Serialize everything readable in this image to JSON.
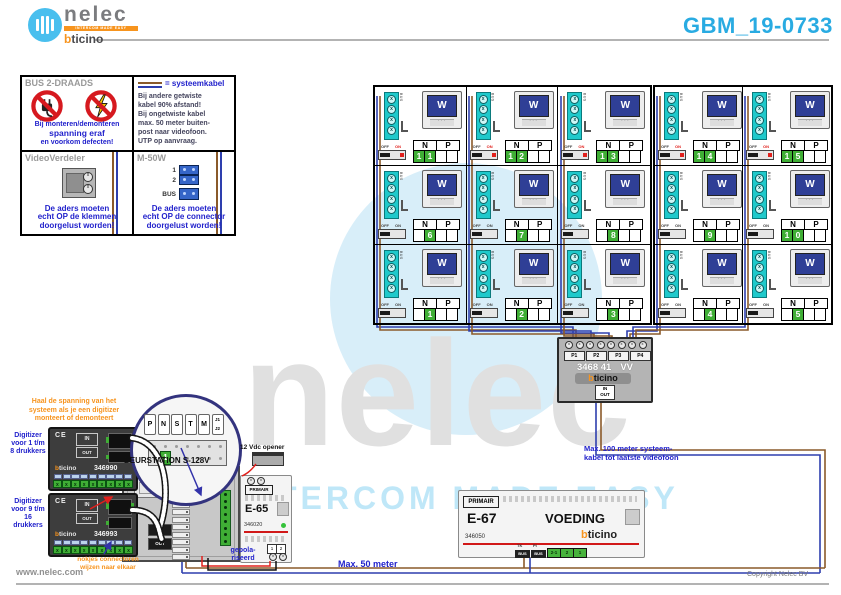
{
  "header": {
    "logo": {
      "name": "nelec",
      "tagline": "INTERCOM MADE EASY",
      "brand_b": "b",
      "brand_rest": "ticino"
    },
    "title": "GBM_19-0733"
  },
  "info": {
    "bus2": {
      "title": "BUS 2-DRAADS",
      "line1": "Bij monteren/demonteren",
      "line2": "spanning eraf",
      "line3": "en voorkom defecten!"
    },
    "kabel": {
      "legend": "= systeemkabel",
      "text": "Bij andere getwiste\nkabel 90% afstand!\nBij ongetwiste kabel\nmax. 50 meter buiten-\npost naar videofoon.\nUTP op aanvraag."
    },
    "verdeler": {
      "title": "VideoVerdeler",
      "text": "De aders moeten\necht OP de klemmen\ndoorgelust worden!"
    },
    "m50w": {
      "title": "M-50W",
      "labels": [
        "1",
        "2",
        "BUS"
      ],
      "text": "De aders moeten\necht OP de connector\ndoorgelust worden!"
    }
  },
  "monitor": {
    "screen": "W",
    "bus": "BUS",
    "off": "OFF",
    "on": "ON",
    "n": "N",
    "p": "P"
  },
  "grids": {
    "left": [
      [
        {
          "d": [
            "1",
            "1"
          ],
          "t": true
        },
        {
          "d": [
            "1",
            "2"
          ],
          "t": true
        },
        {
          "d": [
            "1",
            "3"
          ],
          "t": true
        }
      ],
      [
        {
          "d": [
            "",
            "6"
          ]
        },
        {
          "d": [
            "",
            "7"
          ]
        },
        {
          "d": [
            "",
            "8"
          ]
        }
      ],
      [
        {
          "d": [
            "",
            "1"
          ]
        },
        {
          "d": [
            "",
            "2"
          ]
        },
        {
          "d": [
            "",
            "3"
          ]
        }
      ]
    ],
    "right": [
      [
        {
          "d": [
            "1",
            "4"
          ],
          "t": true
        },
        {
          "d": [
            "1",
            "5"
          ],
          "t": true
        }
      ],
      [
        {
          "d": [
            "",
            "9"
          ]
        },
        {
          "d": [
            "1",
            "0"
          ]
        }
      ],
      [
        {
          "d": [
            "",
            "4"
          ]
        },
        {
          "d": [
            "",
            "5"
          ]
        }
      ]
    ]
  },
  "distributor": {
    "ports": [
      "P1",
      "P2",
      "P3",
      "P4"
    ],
    "model": "3468 41",
    "suffix": "VV",
    "in": "IN",
    "out": "OUT"
  },
  "deurstation": {
    "label": "DEURSTATION S-128V",
    "slots": [
      "P",
      "N",
      "S",
      "T",
      "M"
    ],
    "jumper": "J1\nJ2",
    "config_value": "1",
    "in": "IN",
    "out": "OUT"
  },
  "digitizers": [
    {
      "label": "Digitizer\nvoor\n1 t/m 8\ndrukkers",
      "ce": "CE",
      "in": "IN",
      "out": "OUT",
      "model": "346990"
    },
    {
      "label": "Digitizer\nvoor\n9 t/m 16\ndrukkers",
      "ce": "CE",
      "in": "IN",
      "out": "OUT",
      "model": "346993"
    }
  ],
  "e65": {
    "primair": "PRIMAIR",
    "model": "E-65",
    "code": "346020",
    "terminals": [
      "1",
      "2"
    ],
    "note": "gepola-\nriseerd"
  },
  "e67": {
    "primair": "PRIMAIR",
    "model": "E-67",
    "type": "VOEDING",
    "code": "346050",
    "top_labels": [
      "TK",
      "PI"
    ],
    "bus_terminals": [
      "BUS",
      "BUS"
    ],
    "terminals": [
      "2-1",
      "2",
      "1"
    ]
  },
  "notes": {
    "digitizer_power": "Haal de spanning van het\nsysteem als je een digitizer\nmonteert of demonteert",
    "connectors": "nokjes connectoren\nwijzen naar elkaar",
    "opener": "12 Vdc opener",
    "max100": "Max. 100 meter systeem-\nkabel tot laatste videofoon",
    "max50": "Max. 50 meter"
  },
  "watermark": {
    "name": "nelec",
    "tagline": "INTERCOM MADE EASY"
  },
  "footer": {
    "site": "www.nelec.com",
    "copyright": "Copyright Nelec BV"
  }
}
